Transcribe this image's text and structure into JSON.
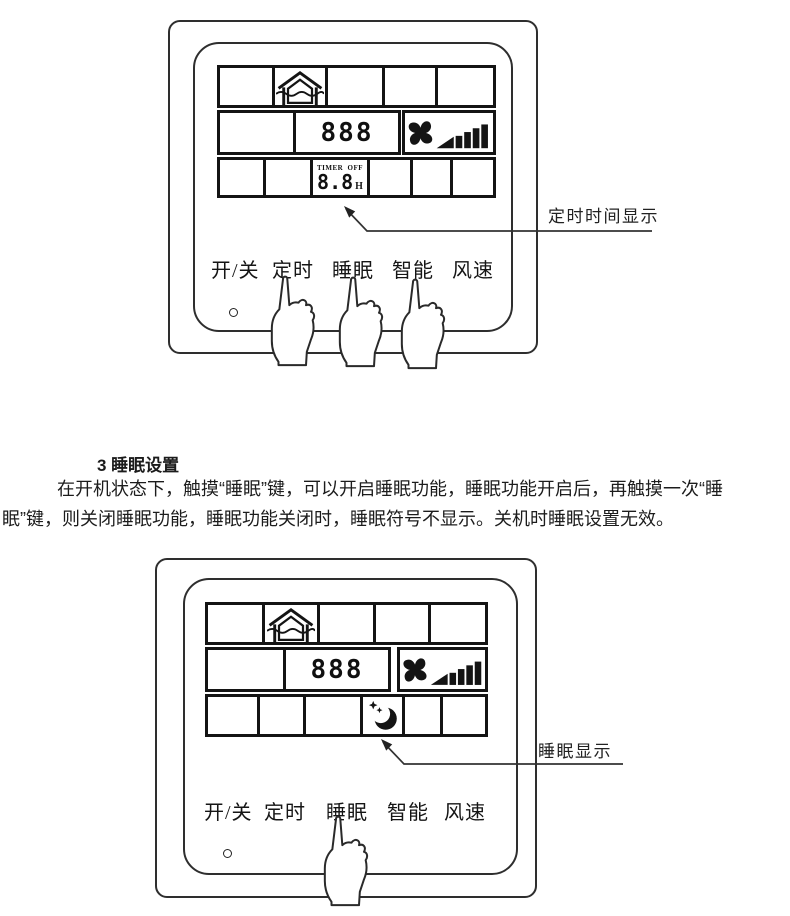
{
  "section": {
    "heading": "3 睡眠设置",
    "para_line1": "在开机状态下，触摸“睡眠”键，可以开启睡眠功能，睡眠功能开启后，再触摸一次“睡",
    "para_line2": "眠”键，则关闭睡眠功能，睡眠功能关闭时，睡眠符号不显示。关机时睡眠设置无效。"
  },
  "panels": [
    {
      "name": "timer-setting-panel",
      "annotation": "定时时间显示",
      "display": {
        "value": "888",
        "timer_title": "TIMER",
        "timer_state": "OFF",
        "timer_value": "8.8",
        "timer_unit": "H"
      },
      "buttons": [
        "开/关",
        "定时",
        "睡眠",
        "智能",
        "风速"
      ]
    },
    {
      "name": "sleep-setting-panel",
      "annotation": "睡眠显示",
      "display": {
        "value": "888"
      },
      "buttons": [
        "开/关",
        "定时",
        "睡眠",
        "智能",
        "风速"
      ]
    }
  ],
  "icons": {
    "house": "house-ventilation-icon",
    "fan": "fan-speed-icon",
    "moon": "sleep-moon-icon",
    "hand": "pointing-hand-icon",
    "led": "indicator-led"
  },
  "colors": {
    "ink": "#141414",
    "background": "#ffffff"
  }
}
